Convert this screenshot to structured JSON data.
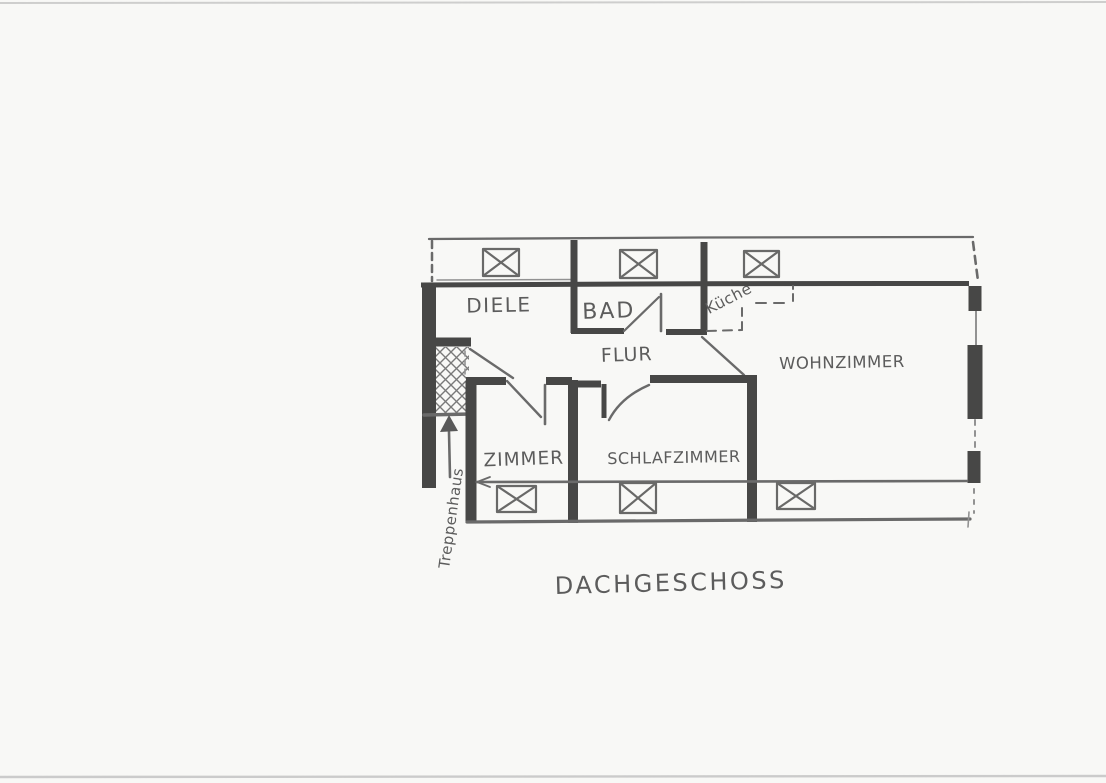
{
  "floorplan": {
    "title": "DACHGESCHOSS",
    "rooms": [
      {
        "id": "diele",
        "label": "DIELE"
      },
      {
        "id": "bad",
        "label": "BAD"
      },
      {
        "id": "kueche",
        "label": "Küche"
      },
      {
        "id": "flur",
        "label": "FLUR"
      },
      {
        "id": "wohnzimmer",
        "label": "WOHNZIMMER"
      },
      {
        "id": "zimmer",
        "label": "ZIMMER"
      },
      {
        "id": "schlafzimmer",
        "label": "SCHLAFZIMMER"
      }
    ],
    "annotation": {
      "id": "treppenhaus",
      "label": "Treppenhaus"
    },
    "windows": {
      "top_count": 3,
      "bottom_count": 3
    },
    "colors": {
      "pencil": "#4f4f4f",
      "wall": "#383838",
      "paper": "#f8f8f6"
    }
  },
  "icons": {
    "window": "window-icon: rectangle crossed with X",
    "staircase": "staircase-hatch-icon: crosshatched square",
    "arrow": "arrow-up-icon: filled triangle with stem"
  }
}
